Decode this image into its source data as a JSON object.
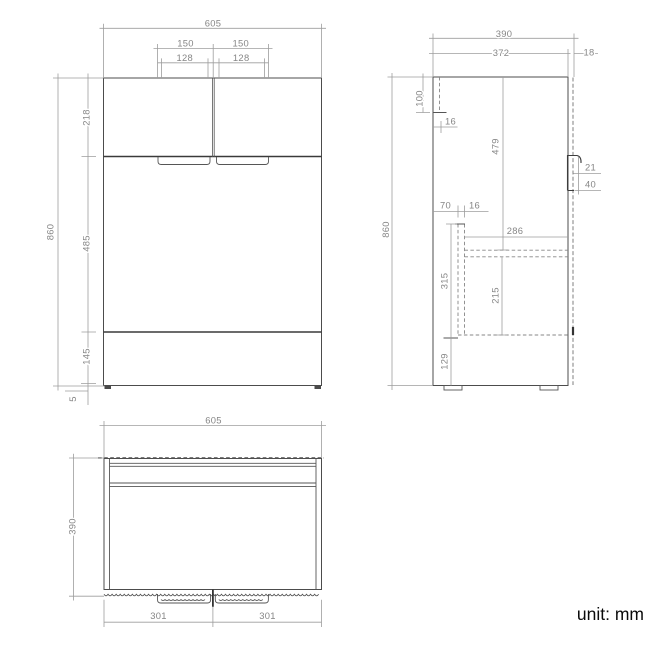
{
  "footer": {
    "unit_label": "unit: mm"
  },
  "views": {
    "front": {
      "dims": {
        "overall_width": "605",
        "handle_left_outer": "150",
        "handle_right_outer": "150",
        "handle_left_inner": "128",
        "handle_right_inner": "128",
        "overall_height": "860",
        "section_top": "218",
        "section_middle": "485",
        "section_bottom": "145",
        "bottom_gap": "5"
      }
    },
    "side": {
      "dims": {
        "overall_depth": "390",
        "carcass_depth": "372",
        "front_panel_thickness": "18",
        "overall_height": "860",
        "mount_rail_height": "100",
        "back_panel_thickness": "16",
        "upper_door_height": "479",
        "handle_inset": "21",
        "handle_profile_height": "40",
        "bottom_rail_offset": "70",
        "panel_thickness": "16",
        "inner_shelf_depth": "286",
        "lower_section_height": "315",
        "drawer_inner_height": "215",
        "plinth_height": "129"
      }
    },
    "top": {
      "dims": {
        "overall_width": "605",
        "overall_depth": "390",
        "door_left_width": "301",
        "door_right_width": "301"
      }
    }
  }
}
